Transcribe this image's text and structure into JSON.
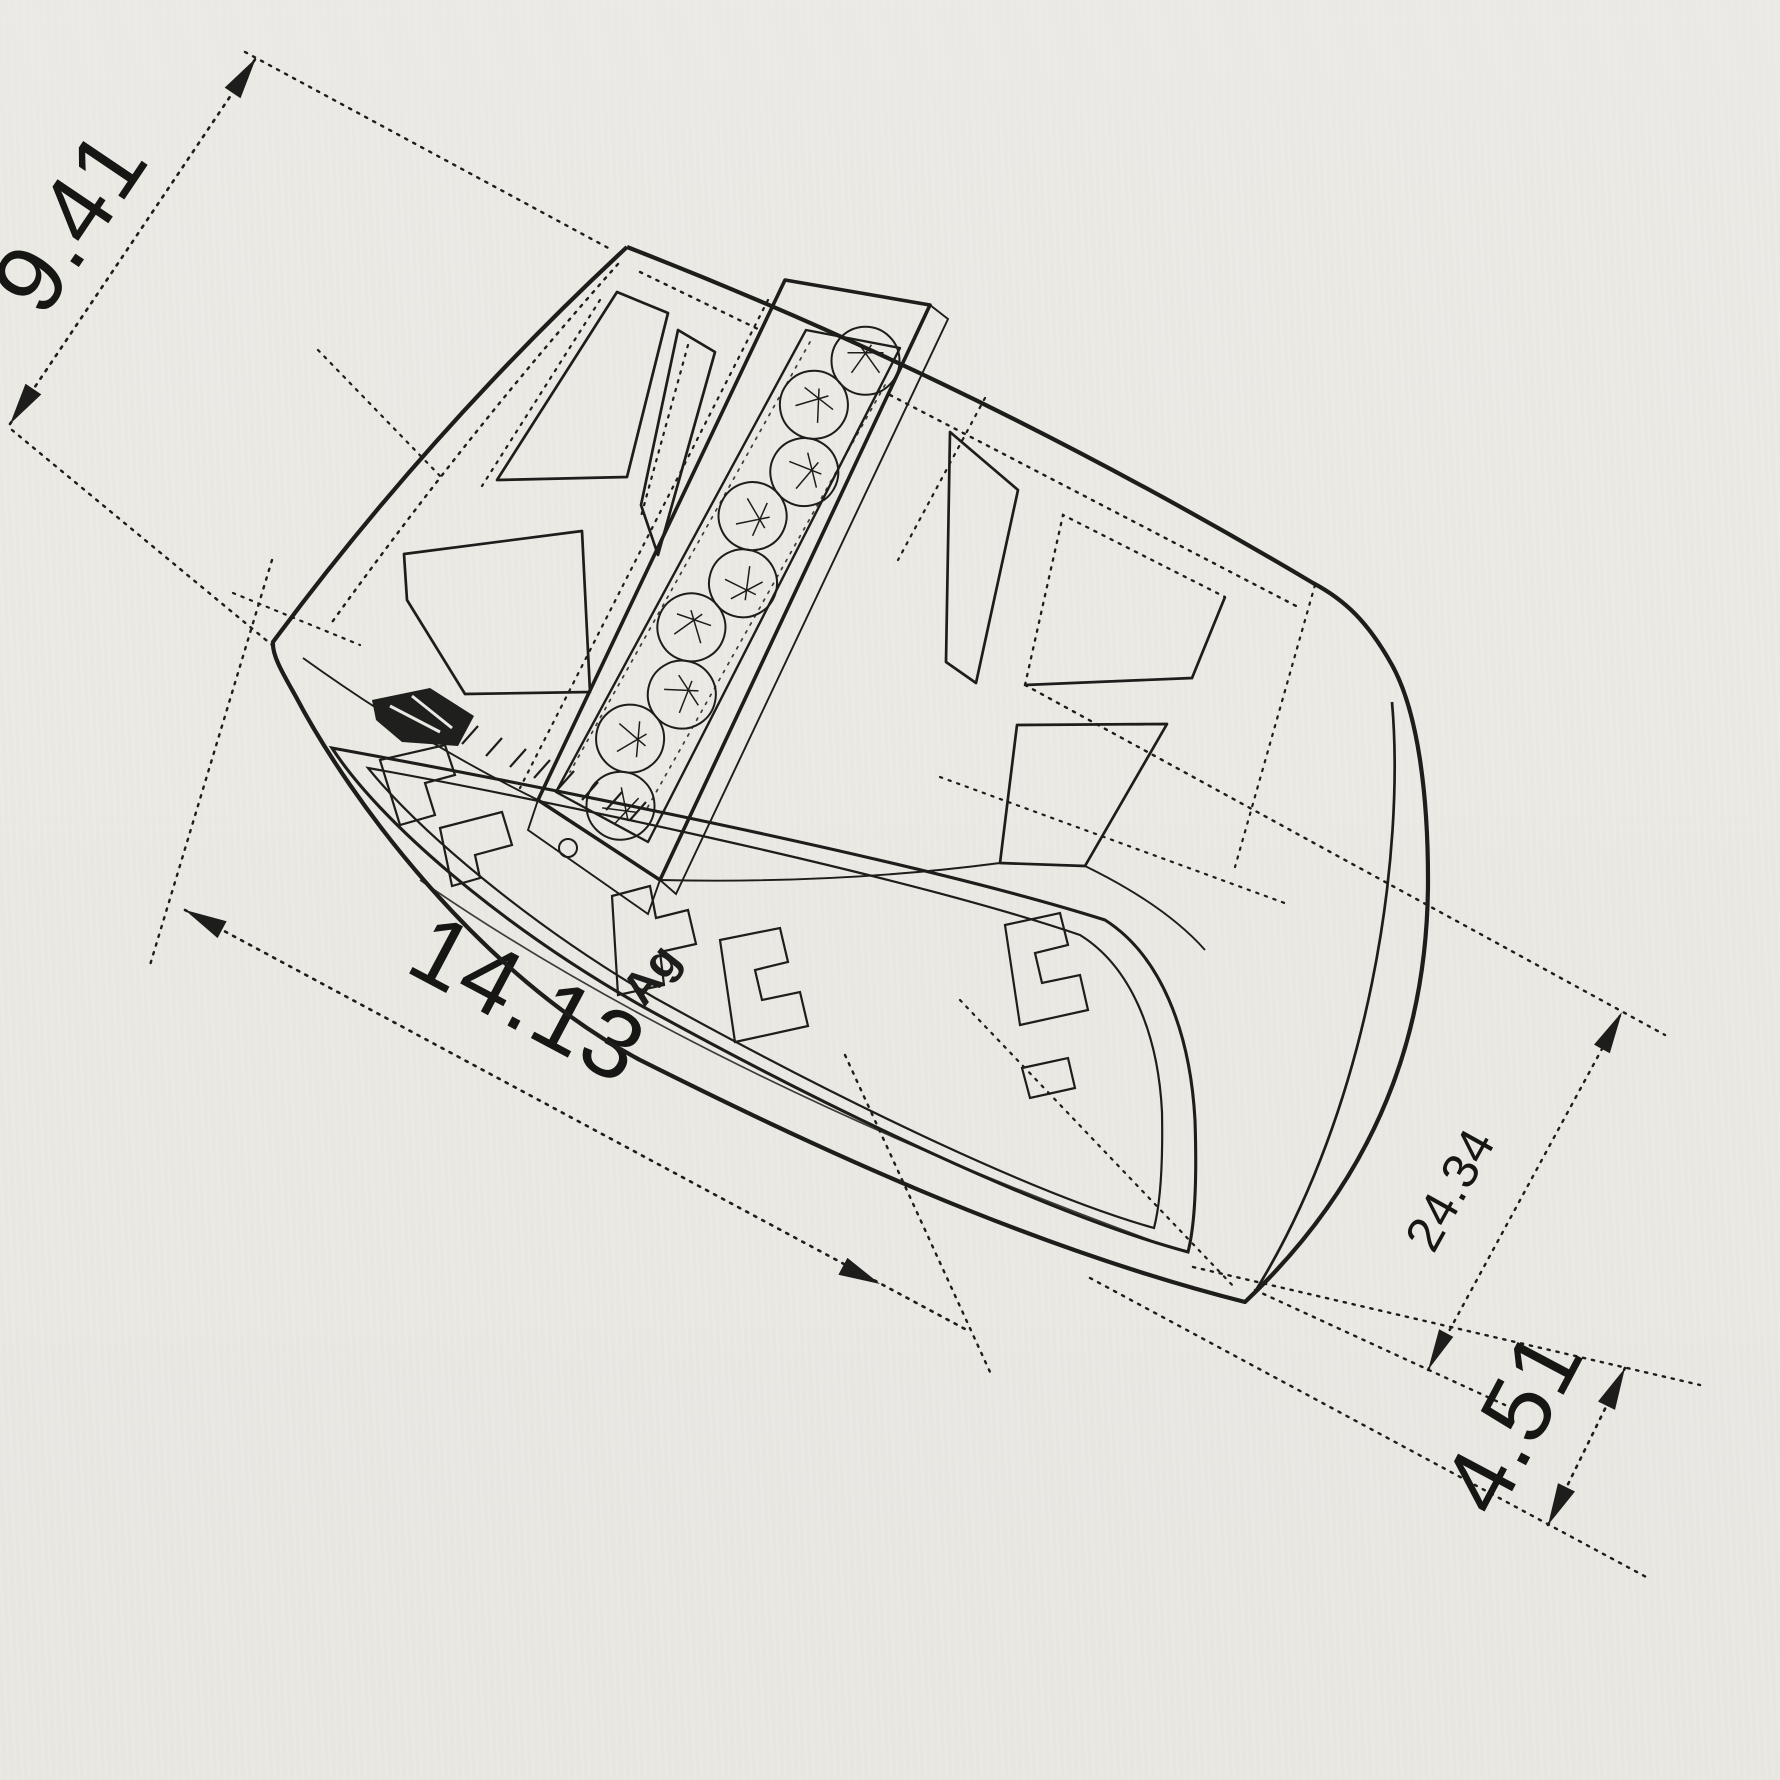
{
  "drawing": {
    "type": "jewelry CAD wireframe - signet ring perspective view",
    "dimensions": [
      {
        "id": "width",
        "label": "9.41"
      },
      {
        "id": "length",
        "label": "14.13"
      },
      {
        "id": "height",
        "label": "24.34"
      },
      {
        "id": "thickness",
        "label": "4.51"
      }
    ],
    "hallmark": "Ag",
    "gem_count": 9,
    "colors": {
      "paper": "#ebe9e4",
      "ink": "#1d1d1b"
    }
  }
}
